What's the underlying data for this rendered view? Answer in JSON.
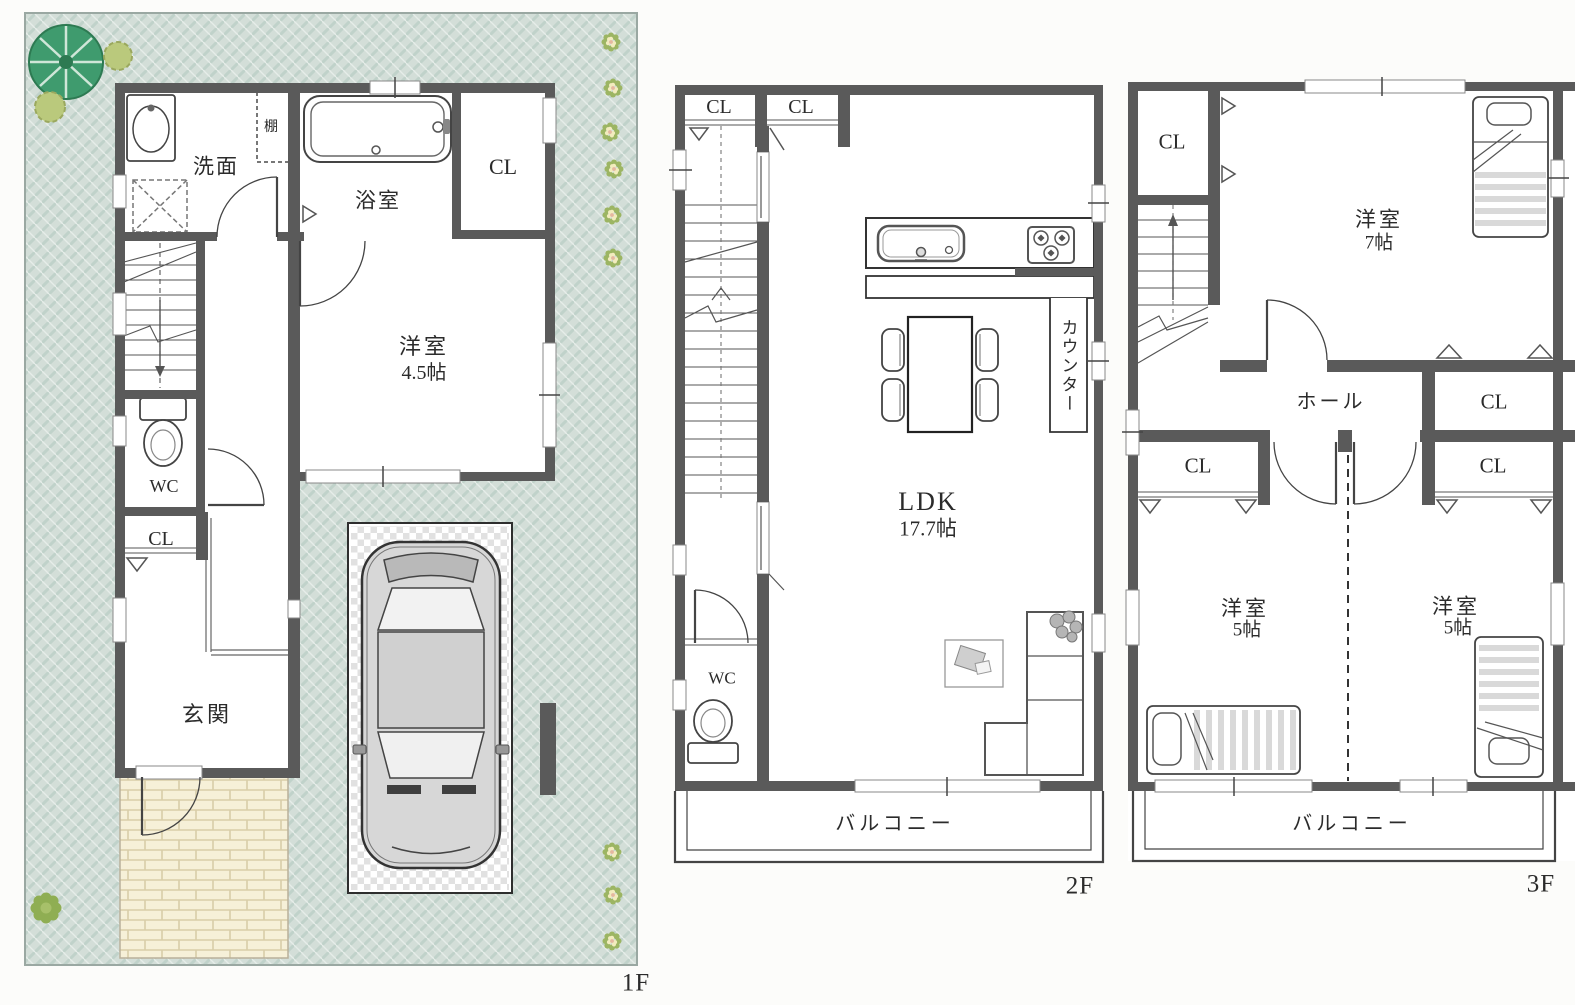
{
  "sheet": {
    "type": "floor-plan",
    "floors": [
      {
        "label": "1F",
        "rooms": {
          "washroom": "洗面",
          "shelf": "棚",
          "bathroom": "浴室",
          "closet_top": "CL",
          "western_room": "洋室",
          "western_room_size": "4.5帖",
          "wc": "WC",
          "closet_lower": "CL",
          "entrance": "玄関"
        }
      },
      {
        "label": "2F",
        "rooms": {
          "closet_left": "CL",
          "closet_right": "CL",
          "ldk": "LDK",
          "ldk_size": "17.7帖",
          "counter": "カウンター",
          "wc": "WC",
          "balcony": "バルコニー"
        }
      },
      {
        "label": "3F",
        "rooms": {
          "closet_top_left": "CL",
          "western_room_7": "洋室",
          "western_room_7_size": "7帖",
          "hall": "ホール",
          "closet_mid_right": "CL",
          "closet_bottom_left": "CL",
          "closet_bottom_right": "CL",
          "western_room_5_left": "洋室",
          "western_room_5_left_size": "5帖",
          "western_room_5_right": "洋室",
          "western_room_5_right_size": "5帖",
          "balcony": "バルコニー"
        }
      }
    ],
    "colors": {
      "wall": "#5a5a5a",
      "lot_green": "#d3ded8",
      "lot_hatch": "#c0d2ca",
      "tree_green": "#3f9b6e",
      "bush_green": "#bac97c",
      "flower_leaf": "#9cb563",
      "flower_petal": "#f2ecbe",
      "flower_center": "#e5b79f",
      "brick": "#f6f0d8",
      "brick_joint": "#d8cda9",
      "car_body": "#d7d7d7",
      "checker_gray": "#dcdcdc",
      "line_dark": "#3a3a3a",
      "text": "#2b2b2b"
    }
  }
}
